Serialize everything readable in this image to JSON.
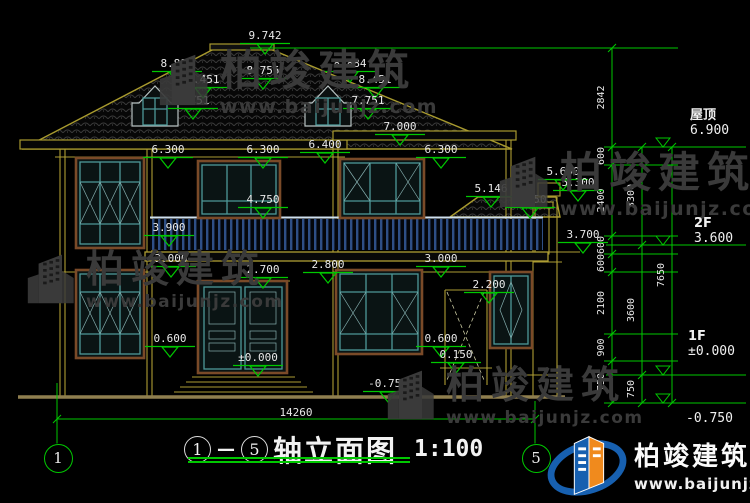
{
  "title_block": {
    "axis_start": "1",
    "dash": "—",
    "axis_end": "5",
    "name": "轴立面图",
    "scale": "1:100"
  },
  "branding": {
    "name": "柏竣建筑",
    "url": "www.baijunjz.com"
  },
  "elev_labels": [
    {
      "t": "9.742",
      "x": 240,
      "y": 30
    },
    {
      "t": "8.884",
      "x": 152,
      "y": 58
    },
    {
      "t": "8.451",
      "x": 178,
      "y": 74
    },
    {
      "t": "8.755",
      "x": 238,
      "y": 65
    },
    {
      "t": "7.751",
      "x": 168,
      "y": 95
    },
    {
      "t": "8.884",
      "x": 325,
      "y": 58
    },
    {
      "t": "8.451",
      "x": 350,
      "y": 74
    },
    {
      "t": "7.751",
      "x": 343,
      "y": 95
    },
    {
      "t": "7.000",
      "x": 375,
      "y": 121
    },
    {
      "t": "6.300",
      "x": 143,
      "y": 144
    },
    {
      "t": "6.300",
      "x": 238,
      "y": 144
    },
    {
      "t": "6.400",
      "x": 300,
      "y": 139
    },
    {
      "t": "6.300",
      "x": 416,
      "y": 144
    },
    {
      "t": "5.600",
      "x": 538,
      "y": 166
    },
    {
      "t": "5.300",
      "x": 553,
      "y": 177
    },
    {
      "t": "5.146",
      "x": 466,
      "y": 183
    },
    {
      "t": "4.750",
      "x": 238,
      "y": 194
    },
    {
      "t": "4.750",
      "x": 505,
      "y": 194
    },
    {
      "t": "3.900",
      "x": 144,
      "y": 222
    },
    {
      "t": "3.700",
      "x": 558,
      "y": 229
    },
    {
      "t": "3.000",
      "x": 146,
      "y": 253
    },
    {
      "t": "2.700",
      "x": 238,
      "y": 264
    },
    {
      "t": "2.800",
      "x": 303,
      "y": 259
    },
    {
      "t": "3.000",
      "x": 416,
      "y": 253
    },
    {
      "t": "2.200",
      "x": 464,
      "y": 279
    },
    {
      "t": "0.600",
      "x": 145,
      "y": 333
    },
    {
      "t": "0.600",
      "x": 416,
      "y": 333
    },
    {
      "t": "0.150",
      "x": 431,
      "y": 349
    },
    {
      "t": "±0.000",
      "x": 233,
      "y": 352
    },
    {
      "t": "-0.750",
      "x": 363,
      "y": 378
    }
  ],
  "right_dims": {
    "top_line": {
      "x1": 250,
      "x2": 672,
      "y": 48
    },
    "columns": [
      {
        "x": 612,
        "label_x": 604,
        "ticks": [
          48,
          147,
          165,
          236,
          254,
          272,
          334,
          361,
          403
        ],
        "labels": [
          "2842",
          "600",
          "2400",
          "600",
          "600",
          "2100",
          "900",
          "750"
        ],
        "ext": true
      },
      {
        "x": 642,
        "label_x": 634,
        "ticks": [
          147,
          245,
          375,
          403
        ],
        "labels": [
          "3300",
          "3600",
          "750"
        ],
        "ext": false
      },
      {
        "x": 672,
        "label_x": 664,
        "ticks": [
          147,
          403
        ],
        "labels": [
          "7650"
        ],
        "ext": false
      }
    ],
    "levels": [
      {
        "name": "屋顶",
        "value": "6.900",
        "y": 147,
        "tx": 690,
        "ty": 104
      },
      {
        "name": "2F",
        "value": "3.600",
        "y": 245,
        "tx": 694,
        "ty": 216
      },
      {
        "name": "1F",
        "value": "±0.000",
        "y": 375,
        "tx": 688,
        "ty": 329
      },
      {
        "name": "",
        "value": "-0.750",
        "y": 403,
        "tx": 686,
        "ty": 411
      }
    ]
  },
  "bottom_dim": {
    "text": "14260",
    "x1": 57,
    "x2": 535,
    "y": 419
  },
  "axis_bubbles": [
    {
      "n": "1",
      "cx": 57,
      "cy": 457,
      "line_y1": 383
    },
    {
      "n": "5",
      "cx": 535,
      "cy": 457,
      "line_y1": 401
    }
  ]
}
